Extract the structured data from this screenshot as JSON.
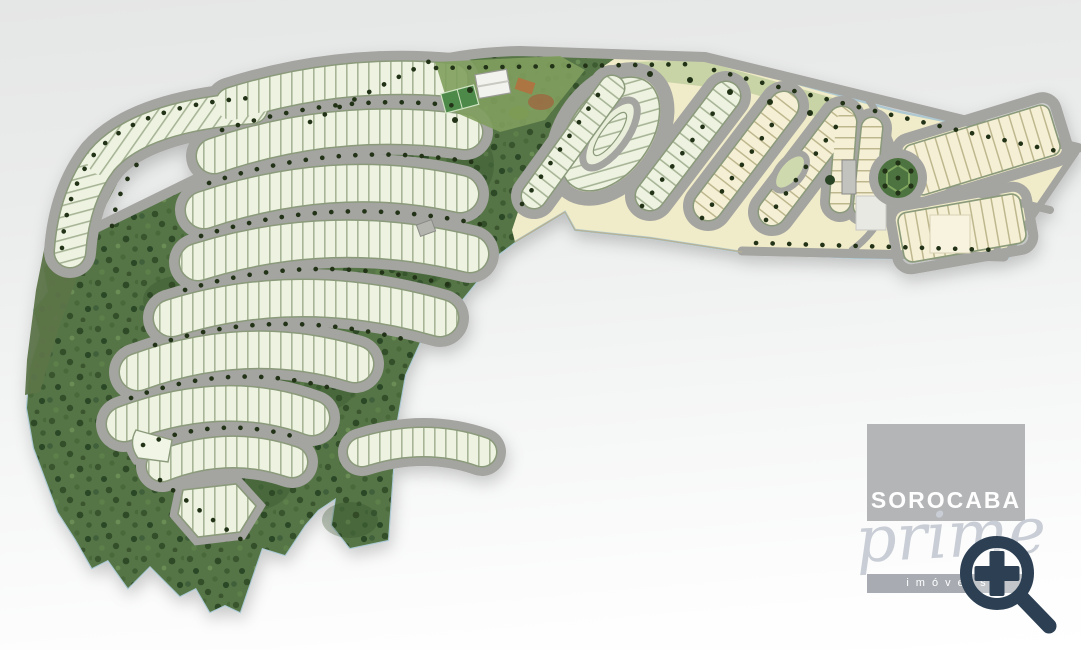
{
  "watermark": {
    "brand_top": "SOROCABA",
    "brand_script": "prime",
    "brand_bottom": "imóveis"
  },
  "map": {
    "type": "residential-masterplan-siteplan",
    "features": [
      "forest-preserve-area",
      "curved-residential-lot-blocks",
      "internal-street-network",
      "perimeter-road",
      "street-trees",
      "clubhouse",
      "sports-courts",
      "oval-loop-block",
      "cul-de-sac",
      "roundabout",
      "entrance-gate",
      "open-reserve-area"
    ]
  },
  "zoom_icon": {
    "name": "magnifier-plus",
    "color": "#2c3f53"
  },
  "colors": {
    "background_top": "#e5e6e6",
    "background_bottom": "#ffffff",
    "forest": "#567546",
    "forest_dark": "#33502b",
    "boundary_outline": "#a5c4d1",
    "road": "#a4a4a0",
    "lot_block": "#eef3e1",
    "lot_block_yellow": "#f5f0d5",
    "lot_tick": "#a7b496",
    "open_area": "#f0ebc8",
    "park_strip": "#c3d2a2",
    "tree_dot": "#223218",
    "court_green": "#4e8a4a",
    "court_clay": "#9c6b42",
    "logo_square": "#b2b3b5",
    "logo_bar": "#a8acb2",
    "brand_navy": "#2c3f53",
    "script_gray": "#c9ced6"
  }
}
